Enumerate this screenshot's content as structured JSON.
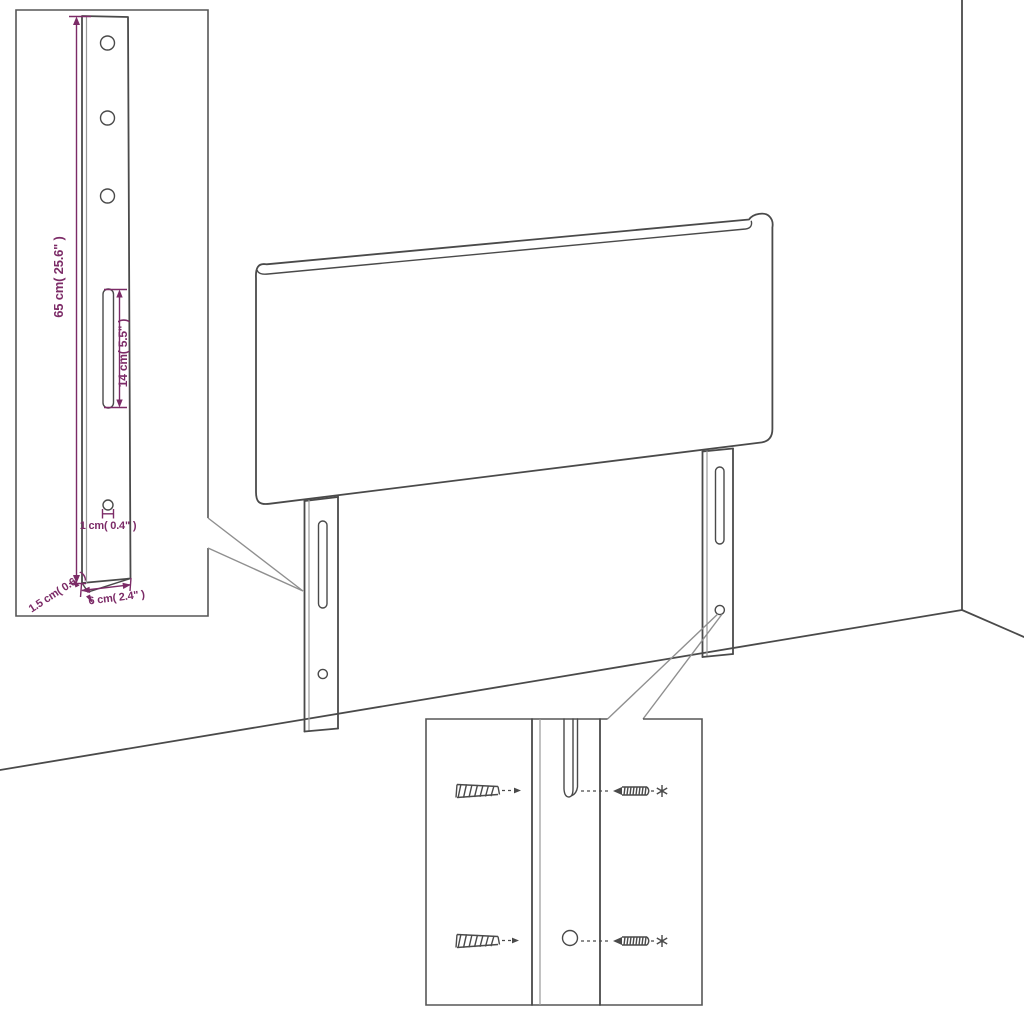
{
  "diagram_title": "Headboard with legs - assembly dimension diagram",
  "colors": {
    "line": "#4a4a4a",
    "line_light": "#9a9a9a",
    "inset_border": "#565656",
    "callout": "#8f8f8f",
    "dimension": "#7c2b67",
    "background": "#ffffff"
  },
  "dims": {
    "total_height": "65 cm( 25.6\" )",
    "slot_length": "14 cm( 5.5\" )",
    "hole_diameter": "1 cm( 0.4\" )",
    "foot_thickness": "1.5 cm( 0.6\" )",
    "leg_width": "6 cm( 2.4\" )"
  }
}
